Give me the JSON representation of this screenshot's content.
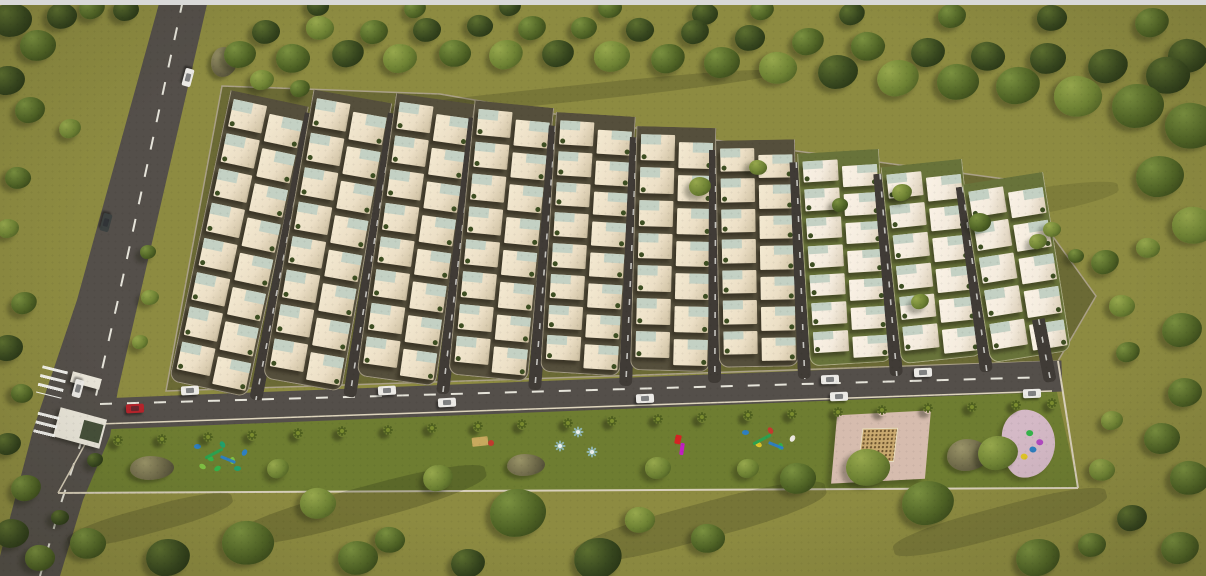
{
  "colors": {
    "top_bar": "#d9d9d8",
    "grass": "#8d8b41",
    "park": "#6e7d31",
    "road": "#544f4a",
    "dash": "#e6e4da",
    "dev_ground": "#6b6a35",
    "block_dark": "#554f3c",
    "block_green": "#68733a",
    "curb": "#ded5bd",
    "house_wall": "#ecdfc6",
    "house_wall_light": "#f4ebdd",
    "roof": "#c4d1c4",
    "shrub": "#3d4e22",
    "outline": "#aaa087",
    "fence": "#d8cfba",
    "white_car": "#eceae6",
    "red_car": "#b5242b",
    "dark_car": "#3c4140",
    "palm": "#4f6020",
    "spinner": "#8fb3ab",
    "rock_hi": "#9a9468",
    "rock_lo": "#4a4733",
    "plaza_pink": "#d6bcae",
    "sand": "#c9a96f",
    "pink_pad": "#d4b9c6",
    "gate_white": "#eae6da",
    "figure_red": "#d42323",
    "figure_magenta": "#c21fc2",
    "bench_tan": "#c8a95e",
    "bench_red": "#c03a2e"
  },
  "terrain": {
    "left_road_poly": [
      [
        160,
        0
      ],
      [
        208,
        0
      ],
      [
        118,
        390
      ],
      [
        110,
        436
      ],
      [
        83,
        500
      ],
      [
        60,
        576
      ],
      [
        0,
        576
      ],
      [
        0,
        556
      ],
      [
        33,
        430
      ],
      [
        77,
        300
      ]
    ],
    "left_road_dash": "M183,0 L118,300 L95,400 L62,500 L40,576",
    "main_road": {
      "x1": 75,
      "y1": 415,
      "x2": 1062,
      "y2": 376,
      "width": 31
    },
    "main_dash": "M100,404 L1050,377",
    "bottom_curb": "M98,424 L1052,391",
    "dev_outline": [
      [
        222,
        86
      ],
      [
        440,
        94
      ],
      [
        670,
        134
      ],
      [
        1012,
        180
      ],
      [
        1096,
        296
      ],
      [
        1058,
        361
      ],
      [
        166,
        391
      ]
    ],
    "park_poly": [
      [
        94,
        425
      ],
      [
        1056,
        388
      ],
      [
        1078,
        488
      ],
      [
        58,
        493
      ]
    ],
    "fence": "M58,493 L1078,488",
    "right_wall": "M1058,361 L1078,488",
    "left_wall": "M58,493 L94,428"
  },
  "development": {
    "columns": [
      {
        "x": 168,
        "top": 92,
        "bottom": 389,
        "rot": 12,
        "rows": 8,
        "w": 80,
        "g": "dark"
      },
      {
        "x": 262,
        "top": 92,
        "bottom": 385,
        "rot": 10,
        "rows": 8,
        "w": 80,
        "g": "dark"
      },
      {
        "x": 356,
        "top": 96,
        "bottom": 381,
        "rot": 8,
        "rows": 8,
        "w": 80,
        "g": "dark"
      },
      {
        "x": 448,
        "top": 103,
        "bottom": 378,
        "rot": 5.5,
        "rows": 8,
        "w": 80,
        "g": "dark"
      },
      {
        "x": 540,
        "top": 114,
        "bottom": 374,
        "rot": 3.5,
        "rows": 8,
        "w": 80,
        "g": "dark"
      },
      {
        "x": 630,
        "top": 127,
        "bottom": 371,
        "rot": 1.5,
        "rows": 7,
        "w": 80,
        "g": "dark"
      },
      {
        "x": 719,
        "top": 140,
        "bottom": 367,
        "rot": -1,
        "rows": 7,
        "w": 80,
        "g": "dark"
      },
      {
        "x": 810,
        "top": 151,
        "bottom": 364,
        "rot": -3.5,
        "rows": 7,
        "w": 82,
        "g": "green"
      },
      {
        "x": 901,
        "top": 162,
        "bottom": 360,
        "rot": -6,
        "rows": 6,
        "w": 82,
        "g": "green"
      },
      {
        "x": 990,
        "top": 176,
        "bottom": 357,
        "rot": -9,
        "rows": 5,
        "w": 82,
        "g": "green"
      }
    ],
    "extra_road": {
      "x": 1044,
      "top": 318,
      "bottom": 382,
      "rot": -11,
      "w": 13
    }
  },
  "shadows": [
    [
      300,
      210,
      180,
      12,
      -38,
      0.2
    ],
    [
      430,
      250,
      200,
      12,
      -38,
      0.18
    ],
    [
      560,
      200,
      180,
      10,
      -38,
      0.16
    ],
    [
      700,
      262,
      200,
      12,
      -38,
      0.16
    ],
    [
      850,
      232,
      160,
      10,
      -38,
      0.14
    ],
    [
      260,
      330,
      160,
      10,
      -38,
      0.16
    ],
    [
      950,
      300,
      140,
      10,
      -38,
      0.13
    ],
    [
      360,
      505,
      260,
      34,
      -15,
      0.22
    ],
    [
      700,
      522,
      260,
      36,
      -15,
      0.2
    ],
    [
      1000,
      522,
      220,
      30,
      -15,
      0.18
    ],
    [
      150,
      520,
      170,
      26,
      -15,
      0.2
    ],
    [
      560,
      95,
      430,
      16,
      -6,
      0.18
    ],
    [
      1000,
      208,
      240,
      26,
      -10,
      0.13
    ]
  ],
  "trees": [
    [
      240,
      55,
      16,
      1
    ],
    [
      266,
      32,
      14,
      0
    ],
    [
      293,
      58,
      17,
      1
    ],
    [
      320,
      28,
      14,
      2
    ],
    [
      348,
      54,
      16,
      0
    ],
    [
      374,
      32,
      14,
      1
    ],
    [
      400,
      58,
      17,
      2
    ],
    [
      427,
      30,
      14,
      0
    ],
    [
      455,
      54,
      16,
      1
    ],
    [
      480,
      26,
      13,
      0
    ],
    [
      506,
      54,
      17,
      2
    ],
    [
      532,
      28,
      14,
      1
    ],
    [
      558,
      54,
      16,
      0
    ],
    [
      584,
      28,
      13,
      1
    ],
    [
      612,
      56,
      18,
      2
    ],
    [
      640,
      30,
      14,
      0
    ],
    [
      668,
      58,
      17,
      1
    ],
    [
      695,
      32,
      14,
      0
    ],
    [
      722,
      62,
      18,
      1
    ],
    [
      750,
      38,
      15,
      0
    ],
    [
      778,
      68,
      19,
      2
    ],
    [
      808,
      42,
      16,
      1
    ],
    [
      838,
      72,
      20,
      0
    ],
    [
      868,
      46,
      17,
      1
    ],
    [
      898,
      78,
      21,
      2
    ],
    [
      928,
      52,
      17,
      0
    ],
    [
      958,
      82,
      21,
      1
    ],
    [
      988,
      56,
      17,
      0
    ],
    [
      1018,
      86,
      22,
      1
    ],
    [
      1048,
      58,
      18,
      0
    ],
    [
      1078,
      96,
      24,
      2
    ],
    [
      1108,
      66,
      20,
      0
    ],
    [
      1138,
      106,
      26,
      1
    ],
    [
      1168,
      76,
      22,
      0
    ],
    [
      1192,
      126,
      27,
      1
    ],
    [
      1188,
      56,
      20,
      0
    ],
    [
      1160,
      176,
      24,
      1
    ],
    [
      1194,
      226,
      22,
      2
    ],
    [
      705,
      14,
      13,
      0
    ],
    [
      762,
      10,
      12,
      1
    ],
    [
      852,
      14,
      13,
      0
    ],
    [
      952,
      16,
      14,
      1
    ],
    [
      1052,
      18,
      15,
      0
    ],
    [
      1152,
      22,
      17,
      1
    ],
    [
      610,
      8,
      12,
      1
    ],
    [
      510,
      6,
      11,
      0
    ],
    [
      415,
      8,
      11,
      1
    ],
    [
      318,
      6,
      11,
      0
    ],
    [
      262,
      80,
      12,
      2
    ],
    [
      300,
      88,
      10,
      1
    ],
    [
      700,
      186,
      11,
      2
    ],
    [
      758,
      168,
      9,
      2
    ],
    [
      980,
      222,
      11,
      1
    ],
    [
      1038,
      242,
      9,
      2
    ],
    [
      902,
      192,
      10,
      2
    ],
    [
      840,
      205,
      8,
      1
    ],
    [
      1105,
      262,
      14,
      1
    ],
    [
      1148,
      248,
      12,
      2
    ],
    [
      1122,
      306,
      13,
      2
    ],
    [
      1182,
      330,
      20,
      1
    ],
    [
      1128,
      352,
      12,
      1
    ],
    [
      1185,
      392,
      17,
      1
    ],
    [
      1112,
      420,
      11,
      2
    ],
    [
      1162,
      438,
      18,
      1
    ],
    [
      1102,
      470,
      13,
      2
    ],
    [
      1190,
      478,
      20,
      1
    ],
    [
      1132,
      518,
      15,
      0
    ],
    [
      1180,
      548,
      19,
      1
    ],
    [
      1092,
      545,
      14,
      1
    ],
    [
      920,
      302,
      9,
      2
    ],
    [
      1052,
      230,
      9,
      2
    ],
    [
      1076,
      256,
      8,
      1
    ],
    [
      12,
      20,
      20,
      0
    ],
    [
      38,
      45,
      18,
      1
    ],
    [
      8,
      80,
      17,
      0
    ],
    [
      30,
      110,
      15,
      1
    ],
    [
      62,
      16,
      15,
      0
    ],
    [
      92,
      8,
      13,
      1
    ],
    [
      126,
      10,
      13,
      0
    ],
    [
      70,
      128,
      11,
      2
    ],
    [
      18,
      178,
      13,
      1
    ],
    [
      8,
      228,
      11,
      2
    ],
    [
      24,
      303,
      13,
      1
    ],
    [
      8,
      348,
      15,
      0
    ],
    [
      22,
      393,
      11,
      1
    ],
    [
      8,
      444,
      13,
      0
    ],
    [
      26,
      488,
      15,
      1
    ],
    [
      12,
      533,
      17,
      0
    ],
    [
      40,
      558,
      15,
      1
    ],
    [
      60,
      518,
      9,
      0
    ],
    [
      95,
      460,
      8,
      0
    ],
    [
      150,
      298,
      9,
      2
    ],
    [
      140,
      342,
      8,
      2
    ],
    [
      148,
      252,
      8,
      1
    ],
    [
      88,
      543,
      18,
      1
    ],
    [
      168,
      558,
      22,
      0
    ],
    [
      248,
      543,
      26,
      1
    ],
    [
      318,
      503,
      18,
      2
    ],
    [
      358,
      558,
      20,
      1
    ],
    [
      438,
      478,
      15,
      2
    ],
    [
      518,
      513,
      28,
      1
    ],
    [
      598,
      558,
      24,
      0
    ],
    [
      658,
      468,
      13,
      2
    ],
    [
      708,
      538,
      17,
      1
    ],
    [
      798,
      478,
      18,
      1
    ],
    [
      868,
      468,
      22,
      2
    ],
    [
      928,
      503,
      26,
      1
    ],
    [
      998,
      453,
      20,
      2
    ],
    [
      1038,
      558,
      22,
      1
    ],
    [
      468,
      563,
      17,
      0
    ],
    [
      278,
      468,
      11,
      2
    ],
    [
      748,
      468,
      11,
      2
    ],
    [
      390,
      540,
      15,
      1
    ],
    [
      640,
      520,
      15,
      2
    ]
  ],
  "palms": [
    118,
    162,
    208,
    252,
    298,
    342,
    388,
    432,
    478,
    522,
    568,
    612,
    658,
    702,
    748,
    792,
    838,
    882,
    928,
    972,
    1016,
    1052
  ],
  "cars": [
    [
      188,
      77,
      105,
      "white"
    ],
    [
      106,
      222,
      105,
      "dark"
    ],
    [
      78,
      388,
      105,
      "white"
    ],
    [
      135,
      408,
      -3,
      "red"
    ],
    [
      190,
      390,
      -3,
      "white"
    ],
    [
      387,
      390,
      -3,
      "white"
    ],
    [
      447,
      402,
      -3,
      "white"
    ],
    [
      645,
      398,
      -2.5,
      "white"
    ],
    [
      830,
      379,
      -2,
      "white"
    ],
    [
      923,
      372,
      -2,
      "white"
    ],
    [
      839,
      396,
      -2,
      "white"
    ],
    [
      1032,
      393,
      -2,
      "white"
    ]
  ],
  "crosswalks": [
    {
      "x": 52,
      "y": 382,
      "w": 26,
      "h": 28,
      "rot": 14
    },
    {
      "x": 46,
      "y": 426,
      "w": 22,
      "h": 24,
      "rot": 14
    }
  ],
  "entrance": [
    {
      "x": 86,
      "y": 380,
      "w": 30,
      "h": 11,
      "rot": 15,
      "inner": false
    },
    {
      "x": 80,
      "y": 428,
      "w": 48,
      "h": 30,
      "rot": 15,
      "inner": true
    }
  ],
  "items": [
    {
      "type": "rock",
      "x": 224,
      "y": 62,
      "w": 26,
      "h": 30
    },
    {
      "type": "playground",
      "x": 222,
      "y": 455,
      "w": 78,
      "h": 44,
      "palette": [
        "#2e7fc0",
        "#35b24a",
        "#22a06b",
        "#7fc043",
        "#2e7fc0",
        "#35b24a",
        "#22a06b",
        "#7fc043"
      ]
    },
    {
      "type": "rock",
      "x": 152,
      "y": 468,
      "w": 44,
      "h": 24
    },
    {
      "type": "bench",
      "x": 484,
      "y": 442,
      "w": 26,
      "h": 14
    },
    {
      "type": "rock",
      "x": 526,
      "y": 465,
      "w": 38,
      "h": 22
    },
    {
      "type": "spinner",
      "x": 578,
      "y": 432
    },
    {
      "type": "spinner",
      "x": 560,
      "y": 446
    },
    {
      "type": "spinner",
      "x": 592,
      "y": 452
    },
    {
      "type": "figure",
      "x": 681,
      "y": 446
    },
    {
      "type": "playground",
      "x": 770,
      "y": 441,
      "w": 44,
      "h": 26,
      "palette": [
        "#2e7fc0",
        "#e0c429",
        "#c23a2e",
        "#35b24a",
        "#ece8e0"
      ]
    },
    {
      "type": "plaza",
      "x": 881,
      "y": 447,
      "w": 94,
      "h": 68
    },
    {
      "type": "rock",
      "x": 968,
      "y": 455,
      "w": 42,
      "h": 32
    },
    {
      "type": "pinkpad",
      "x": 1028,
      "y": 444,
      "w": 54,
      "h": 68,
      "palette": [
        "#35b24a",
        "#2e7fc0",
        "#b049c0",
        "#e0c429"
      ]
    }
  ]
}
